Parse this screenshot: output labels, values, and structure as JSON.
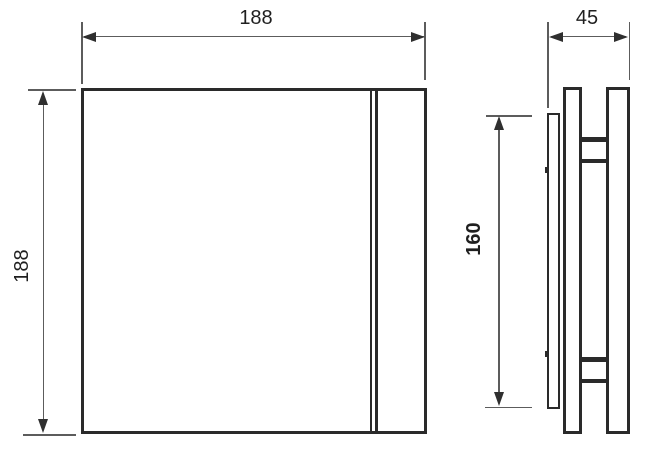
{
  "drawing": {
    "front_view": {
      "width_label": "188",
      "height_label": "188"
    },
    "side_view": {
      "depth_label": "45",
      "inner_height_label": "160"
    },
    "colors": {
      "outline": "#2a2a2a",
      "dimension_line": "#5c5c5c",
      "background": "#ffffff"
    }
  }
}
